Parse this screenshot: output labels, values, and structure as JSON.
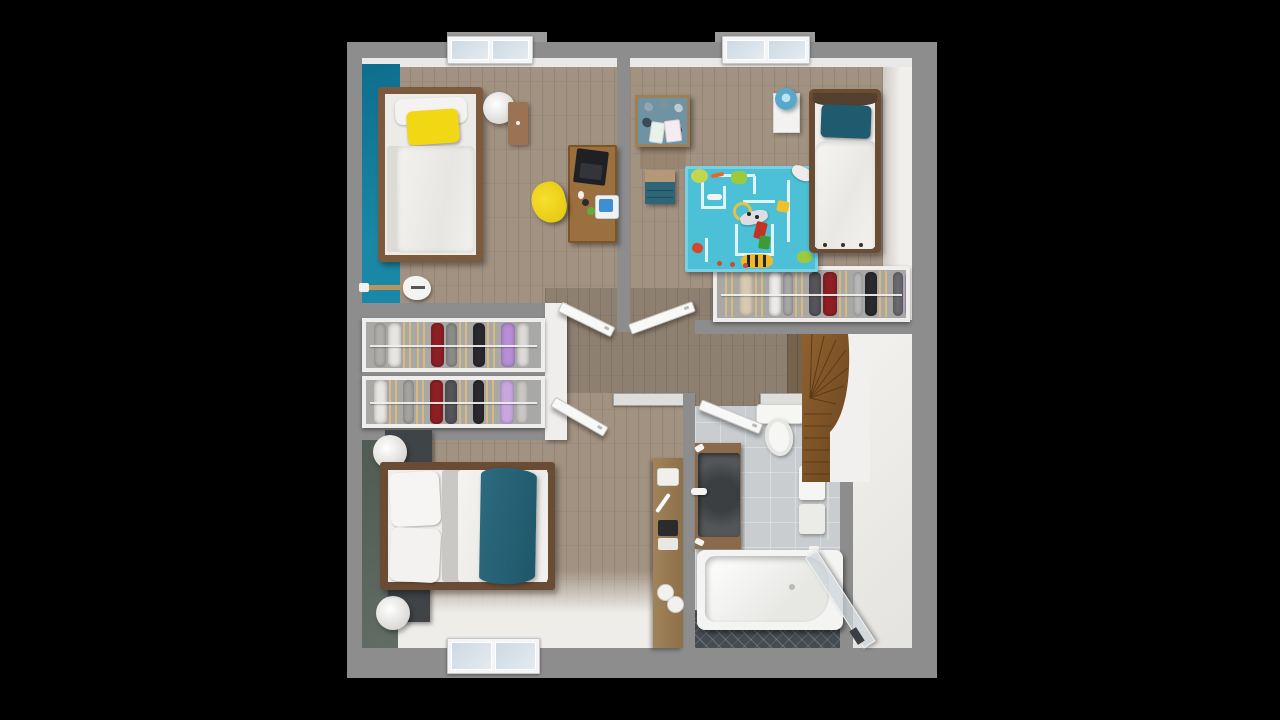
{
  "scene": {
    "kind": "3d-floor-plan-top-view",
    "level": "upper-floor",
    "background": "#000000",
    "rooms": [
      {
        "name": "bedroom-1",
        "accent_wall": "#15819f",
        "furniture": [
          "single-bed",
          "yellow-pillow",
          "white-pillow",
          "pouf",
          "nightstand",
          "desk",
          "laptop",
          "yellow-desk-chair",
          "electric-guitar",
          "window"
        ]
      },
      {
        "name": "kids-bedroom",
        "furniture": [
          "single-bed",
          "teal-pillow",
          "white-nightstand",
          "blue-table-lamp",
          "craft-table",
          "teal-dresser",
          "blue-play-rug",
          "toys",
          "closet-with-clothes",
          "window"
        ]
      },
      {
        "name": "master-bedroom",
        "accent_wall": "#59655c",
        "furniture": [
          "double-bed",
          "teal-bed-runner",
          "dark-nightstand-north",
          "dark-nightstand-south",
          "round-lamp-north",
          "round-lamp-south",
          "window"
        ]
      },
      {
        "name": "bathroom",
        "furniture": [
          "toilet",
          "wood-vanity-with-basin",
          "towel-rail",
          "bathtub",
          "glass-shower-screen",
          "mosaic-floor-strip"
        ]
      },
      {
        "name": "hallway",
        "furniture": [
          "console-table",
          "four-open-doors"
        ]
      },
      {
        "name": "walk-in-wardrobe",
        "furniture": [
          "clothes-rail-row-1",
          "clothes-rail-row-2"
        ]
      },
      {
        "name": "stairwell",
        "furniture": [
          "winder-staircase",
          "curved-white-wall"
        ]
      }
    ]
  },
  "palette": {
    "wall": "#8d8d8d",
    "wall_light": "#dededb",
    "bay": "#9b9b9b",
    "floor1": "#a29282",
    "floor2": "#8e8071",
    "floor3": "#75634e",
    "teal_wall": "#15819f",
    "master_wall": "#59655c",
    "rug": "#4cc0d6",
    "tile": "#c9cdcf",
    "tile_line": "#d9dcde",
    "mosaic": "#454b51",
    "wood_frame1": "#7c5a3d",
    "wood_frame2": "#6a4c35",
    "wood_desk": "#9c6f3f",
    "wood_nstand": "#9b7352",
    "wood_vanity": "#8c6a49",
    "wood_console": "#a08359",
    "wood_stairs": "#8a5c2c",
    "yellow": "#f2d714",
    "teal_kids": "#1f5b6e",
    "teal_master": "#276377",
    "teal_dresser": "#2e6577",
    "lamp_blue": "#57a8cb",
    "dark_nstand": "#3f4447",
    "basin": "#53575a",
    "closet_bg": "#a8a8a6",
    "hanger": "#d9b97c",
    "landing": "#efeeeb",
    "white_band": "#e9e8e6"
  },
  "closets": {
    "kids": {
      "items": [
        {
          "t": "h"
        },
        {
          "t": "c",
          "c": "#d8cab2",
          "w": 14
        },
        {
          "t": "h"
        },
        {
          "t": "c",
          "c": "#ecebe8",
          "w": 12
        },
        {
          "t": "c",
          "c": "#a8a8a8",
          "w": 10
        },
        {
          "t": "h"
        },
        {
          "t": "c",
          "c": "#55555a",
          "w": 12
        },
        {
          "t": "c",
          "c": "#8e2025",
          "w": 14
        },
        {
          "t": "h"
        },
        {
          "t": "c",
          "c": "#b9b9b7",
          "w": 10
        },
        {
          "t": "c",
          "c": "#2a2a2e",
          "w": 12
        },
        {
          "t": "h"
        },
        {
          "t": "c",
          "c": "#6b6b70",
          "w": 10
        },
        {
          "t": "c",
          "c": "#b78ed6",
          "w": 16
        },
        {
          "t": "c",
          "c": "#e4e2df",
          "w": 12
        }
      ]
    },
    "wardrobe_row1": {
      "items": [
        {
          "t": "c",
          "c": "#b0aeab",
          "w": 12
        },
        {
          "t": "c",
          "c": "#e8e6e2",
          "w": 13
        },
        {
          "t": "h"
        },
        {
          "t": "h"
        },
        {
          "t": "c",
          "c": "#8e2025",
          "w": 13
        },
        {
          "t": "c",
          "c": "#8e8c89",
          "w": 11
        },
        {
          "t": "h"
        },
        {
          "t": "c",
          "c": "#2a2a2e",
          "w": 12
        },
        {
          "t": "h"
        },
        {
          "t": "c",
          "c": "#b78ed6",
          "w": 14
        },
        {
          "t": "c",
          "c": "#dddbd7",
          "w": 12
        }
      ]
    },
    "wardrobe_row2": {
      "items": [
        {
          "t": "c",
          "c": "#e8e6e2",
          "w": 13
        },
        {
          "t": "h"
        },
        {
          "t": "c",
          "c": "#a5a3a0",
          "w": 11
        },
        {
          "t": "h"
        },
        {
          "t": "c",
          "c": "#8e2025",
          "w": 13
        },
        {
          "t": "c",
          "c": "#55555a",
          "w": 12
        },
        {
          "t": "h"
        },
        {
          "t": "c",
          "c": "#2a2a2e",
          "w": 11
        },
        {
          "t": "h"
        },
        {
          "t": "c",
          "c": "#c9a8e0",
          "w": 14
        },
        {
          "t": "c",
          "c": "#c9c7c3",
          "w": 12
        }
      ]
    }
  },
  "sprites": {
    "rug": [
      {
        "n": "rug-path",
        "x": 16,
        "y": 8,
        "w": 3,
        "h": 34,
        "c": "#def4f6"
      },
      {
        "n": "rug-path",
        "x": 16,
        "y": 40,
        "w": 24,
        "h": 3,
        "c": "#def4f6"
      },
      {
        "n": "rug-path",
        "x": 38,
        "y": 20,
        "w": 3,
        "h": 23,
        "c": "#def4f6"
      },
      {
        "n": "rug-path",
        "x": 30,
        "y": 8,
        "w": 40,
        "h": 3,
        "c": "#def4f6"
      },
      {
        "n": "rug-path",
        "x": 68,
        "y": 10,
        "w": 3,
        "h": 18,
        "c": "#def4f6"
      },
      {
        "n": "rug-path",
        "x": 50,
        "y": 58,
        "w": 3,
        "h": 32,
        "c": "#def4f6"
      },
      {
        "n": "rug-path",
        "x": 50,
        "y": 87,
        "w": 38,
        "h": 3,
        "c": "#def4f6"
      },
      {
        "n": "rug-path",
        "x": 86,
        "y": 58,
        "w": 3,
        "h": 32,
        "c": "#def4f6"
      },
      {
        "n": "rug-path",
        "x": 58,
        "y": 34,
        "w": 32,
        "h": 3,
        "c": "#def4f6"
      },
      {
        "n": "rug-path",
        "x": 102,
        "y": 14,
        "w": 3,
        "h": 62,
        "c": "#def4f6"
      },
      {
        "n": "rug-path",
        "x": 20,
        "y": 72,
        "w": 3,
        "h": 24,
        "c": "#def4f6"
      },
      {
        "n": "toy-tree",
        "x": 6,
        "y": 3,
        "w": 17,
        "h": 14,
        "c": "#c3d64e",
        "r": "50%"
      },
      {
        "n": "toy-carrot",
        "x": 26,
        "y": 7,
        "w": 13,
        "h": 4,
        "c": "#e06b28",
        "r": "2px",
        "rot": -12
      },
      {
        "n": "toy-elephant",
        "x": 46,
        "y": 5,
        "w": 16,
        "h": 13,
        "c": "#9cc93e",
        "r": "40%"
      },
      {
        "n": "toy-plane",
        "x": 106,
        "y": 1,
        "w": 22,
        "h": 13,
        "c": "#ececec",
        "r": "40% 40% 50% 50%",
        "rot": 28,
        "sh": "0 1px 2px rgba(0,0,0,.3)"
      },
      {
        "n": "toy-bone",
        "x": 22,
        "y": 28,
        "w": 15,
        "h": 6,
        "c": "#f4f4f2",
        "r": "3px"
      },
      {
        "n": "toy-ring",
        "x": 48,
        "y": 36,
        "w": 13,
        "h": 13,
        "c": "transparent",
        "r": "50%",
        "b": "3px solid #e6c43e"
      },
      {
        "n": "toy-dalmatian",
        "x": 55,
        "y": 45,
        "w": 28,
        "h": 13,
        "c": "#dddde1",
        "r": "40%",
        "rot": -14,
        "sh": "0 1px 2px rgba(0,0,0,.3)"
      },
      {
        "n": "toy-spot",
        "x": 62,
        "y": 46,
        "w": 4,
        "h": 4,
        "c": "#26262a",
        "r": "50%"
      },
      {
        "n": "toy-spot",
        "x": 70,
        "y": 49,
        "w": 4,
        "h": 4,
        "c": "#26262a",
        "r": "50%"
      },
      {
        "n": "toy-cheese",
        "x": 92,
        "y": 35,
        "w": 12,
        "h": 11,
        "c": "#efc02f",
        "r": "20%",
        "rot": 10
      },
      {
        "n": "toy-block-red",
        "x": 70,
        "y": 56,
        "w": 11,
        "h": 17,
        "c": "#c23326",
        "r": "2px",
        "rot": 14
      },
      {
        "n": "toy-block-green",
        "x": 74,
        "y": 70,
        "w": 11,
        "h": 13,
        "c": "#3e9939",
        "r": "2px",
        "rot": 8
      },
      {
        "n": "toy-tiger",
        "x": 56,
        "y": 88,
        "w": 32,
        "h": 14,
        "c": "#efb92b",
        "r": "40%"
      },
      {
        "n": "toy-tiger-stripe",
        "x": 62,
        "y": 89,
        "w": 3,
        "h": 12,
        "c": "#26262a"
      },
      {
        "n": "toy-tiger-stripe",
        "x": 70,
        "y": 89,
        "w": 3,
        "h": 12,
        "c": "#26262a"
      },
      {
        "n": "toy-tiger-stripe",
        "x": 78,
        "y": 89,
        "w": 3,
        "h": 12,
        "c": "#26262a"
      },
      {
        "n": "toy-butterfly",
        "x": 7,
        "y": 77,
        "w": 11,
        "h": 10,
        "c": "#d5472c",
        "r": "45%",
        "rot": 20
      },
      {
        "n": "toy-flower",
        "x": 32,
        "y": 95,
        "w": 5,
        "h": 5,
        "c": "#cf4a34",
        "r": "50%"
      },
      {
        "n": "toy-flower",
        "x": 45,
        "y": 96,
        "w": 5,
        "h": 5,
        "c": "#cf4a34",
        "r": "50%"
      },
      {
        "n": "toy-flower",
        "x": 58,
        "y": 97,
        "w": 5,
        "h": 5,
        "c": "#cf4a34",
        "r": "50%"
      },
      {
        "n": "toy-green-blob",
        "x": 112,
        "y": 85,
        "w": 15,
        "h": 12,
        "c": "#9cc93e",
        "r": "45%"
      }
    ],
    "craft_table": [
      {
        "n": "heart-decor",
        "x": 6,
        "y": 5,
        "w": 9,
        "h": 8,
        "c": "#93a5b0",
        "r": "50% 50% 65% 65%",
        "rot": 40
      },
      {
        "n": "heart-decor",
        "x": 22,
        "y": 3,
        "w": 8,
        "h": 7,
        "c": "#7e929e",
        "r": "50%",
        "rot": 40
      },
      {
        "n": "heart-decor",
        "x": 36,
        "y": 6,
        "w": 9,
        "h": 8,
        "c": "#bfc9cf",
        "r": "50%",
        "rot": 40
      },
      {
        "n": "heart-decor",
        "x": 4,
        "y": 20,
        "w": 10,
        "h": 9,
        "c": "#3b4a54",
        "r": "50%",
        "rot": 40
      },
      {
        "n": "heart-decor",
        "x": 36,
        "y": 28,
        "w": 8,
        "h": 8,
        "c": "#3b4a54",
        "r": "50%",
        "rot": 40
      },
      {
        "n": "card",
        "x": 12,
        "y": 24,
        "w": 12,
        "h": 19,
        "c": "#eaf1ea",
        "r": "2px",
        "rot": 8,
        "b": "1px solid #ccd6cc"
      },
      {
        "n": "card",
        "x": 27,
        "y": 22,
        "w": 14,
        "h": 20,
        "c": "#f5ecf1",
        "r": "2px",
        "rot": -7,
        "b": "1px solid #d8c9d2"
      }
    ],
    "desk": [
      {
        "n": "laptop",
        "x": 5,
        "y": 3,
        "w": 32,
        "h": 34,
        "c": "#1f2024",
        "r": "2px",
        "rot": 7
      },
      {
        "n": "laptop-keys",
        "x": 10,
        "y": 17,
        "w": 22,
        "h": 15,
        "c": "#34353b",
        "r": "1px",
        "rot": 7
      },
      {
        "n": "mouse",
        "x": 8,
        "y": 44,
        "w": 6,
        "h": 8,
        "c": "#f0f0ee",
        "r": "50%"
      },
      {
        "n": "cup",
        "x": 12,
        "y": 52,
        "w": 7,
        "h": 7,
        "c": "#2a2b2f",
        "r": "50%"
      },
      {
        "n": "printer",
        "x": 25,
        "y": 48,
        "w": 22,
        "h": 22,
        "c": "#eef2f4",
        "r": "3px",
        "b": "1px solid #c3cdd3"
      },
      {
        "n": "printer-lid",
        "x": 29,
        "y": 52,
        "w": 14,
        "h": 13,
        "c": "#3f8ed4",
        "r": "2px"
      },
      {
        "n": "plant",
        "x": 17,
        "y": 60,
        "w": 8,
        "h": 8,
        "c": "#5fae3d",
        "r": "50%"
      }
    ],
    "console": [
      {
        "n": "tray",
        "x": 4,
        "y": 10,
        "w": 20,
        "h": 16,
        "c": "#f0efec",
        "r": "3px",
        "b": "1px solid #d5d3cf"
      },
      {
        "n": "toothbrush",
        "x": 8,
        "y": 34,
        "w": 4,
        "h": 22,
        "c": "#fafafa",
        "rot": 35,
        "r": "2px"
      },
      {
        "n": "towel-stack-dark",
        "x": 5,
        "y": 62,
        "w": 20,
        "h": 16,
        "c": "#2b2b2e",
        "r": "2px"
      },
      {
        "n": "towel-stack-light",
        "x": 5,
        "y": 80,
        "w": 20,
        "h": 12,
        "c": "#e8e7e4",
        "r": "2px"
      },
      {
        "n": "roll",
        "x": 4,
        "y": 126,
        "w": 15,
        "h": 15,
        "c": "#f2f1ee",
        "r": "50%",
        "b": "1px solid #d0cecb"
      },
      {
        "n": "roll",
        "x": 14,
        "y": 138,
        "w": 15,
        "h": 15,
        "c": "#f2f1ee",
        "r": "50%",
        "b": "1px solid #d0cecb"
      }
    ]
  }
}
